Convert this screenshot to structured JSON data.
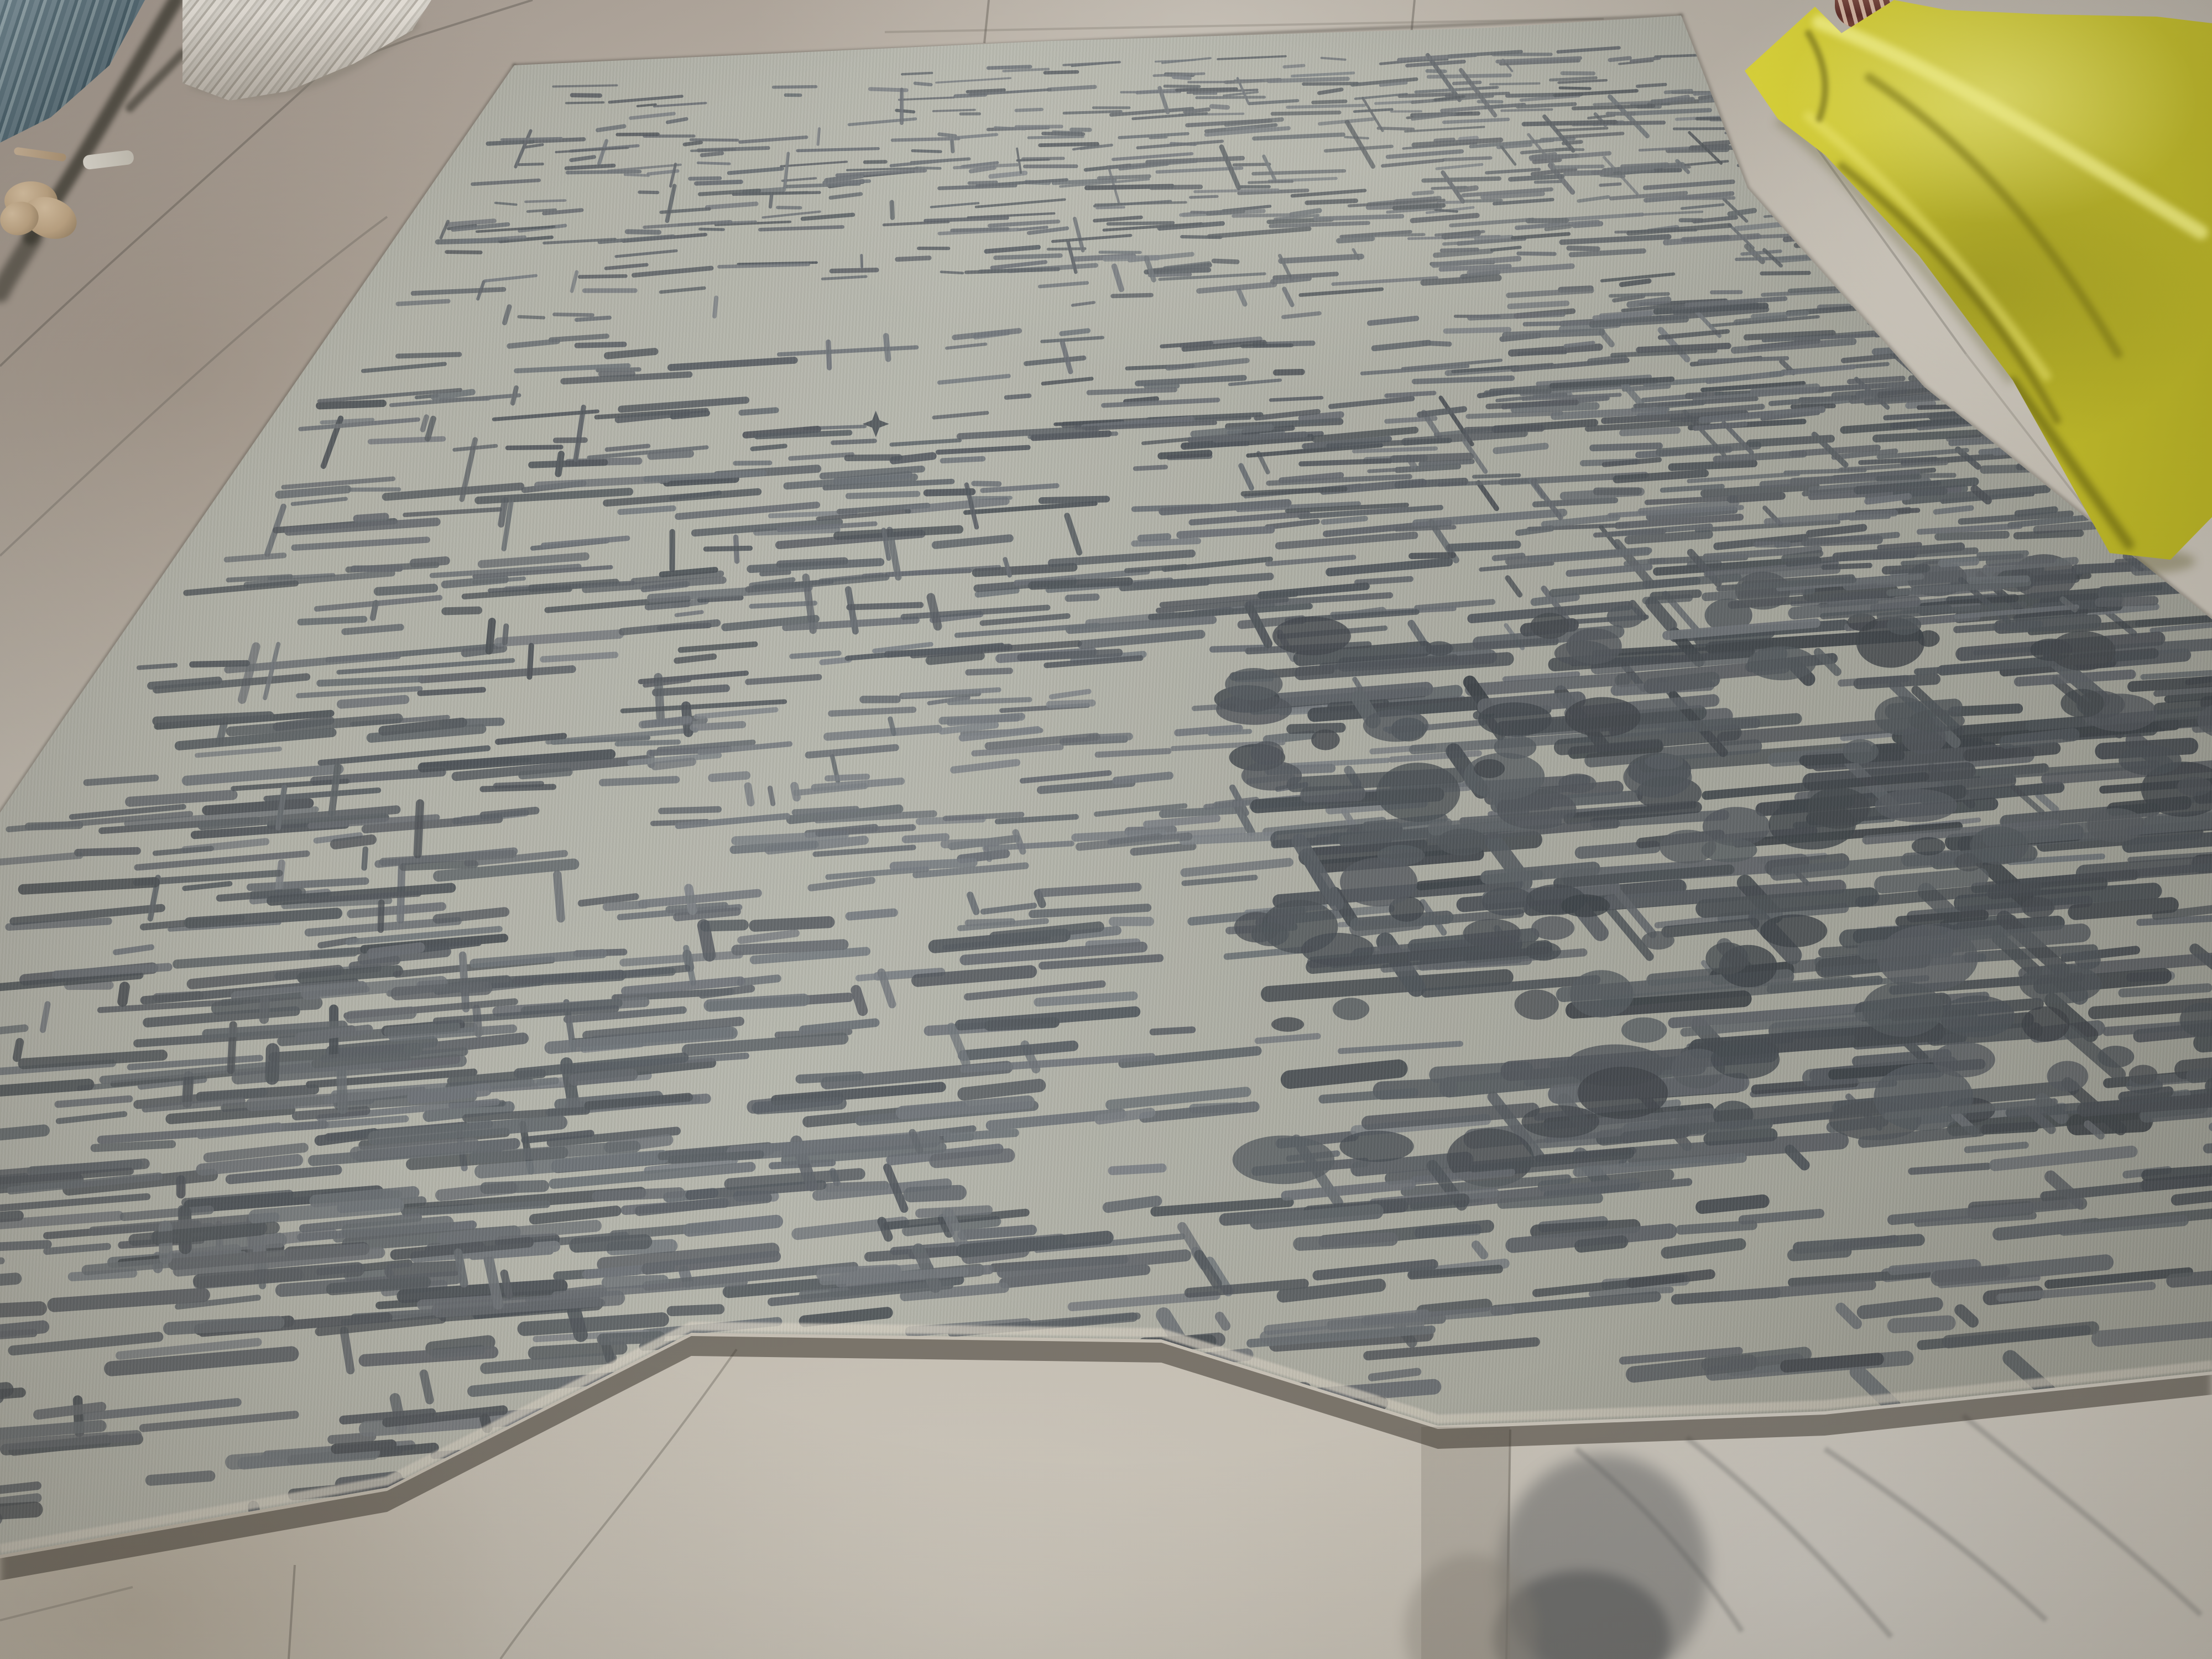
{
  "scene": {
    "type": "photograph",
    "description": "Large gray hand-tufted area rug with an abstract charcoal scratched-grid pattern, laid on a white marble showroom floor; a crumpled bright-yellow tarp lies at the top right, a blue plastic crate and a rolled white carpet at the top left, with a small tan yarn bundle nearby.",
    "objects": [
      {
        "name": "area-rug",
        "color": "#b2b3a9",
        "pattern_color": "#3e444a"
      },
      {
        "name": "marble-floor",
        "color": "#c0bab0"
      },
      {
        "name": "yellow-tarp",
        "color": "#e4dd35"
      },
      {
        "name": "plastic-crate",
        "color": "#5d7985"
      },
      {
        "name": "rolled-carpet",
        "color": "#d8d3c9"
      },
      {
        "name": "yarn-bundle",
        "color": "#c3a987"
      },
      {
        "name": "rope-strand",
        "color": "#c0a788"
      },
      {
        "name": "fabric-scrap",
        "color": "#dcd8ce"
      },
      {
        "name": "sandal-foot",
        "color": "#6b3730"
      }
    ]
  },
  "palette": {
    "floor_pink": "#a89d93",
    "floor_light": "#c7c2b8",
    "floor_bottom": "#c3bcb0",
    "floor_white_tile": "#cbc8c2",
    "floor_dark_vein": "#5e6062",
    "rug_ground": "#b2b3a9",
    "rug_mark_light": "#7d8287",
    "rug_mark_dark": "#3e444a",
    "rug_binding": "#d5cfc2",
    "cast_shadow": "#4a463f",
    "tarp_yellow": "#e4dd35",
    "tarp_highlight": "#f6f283",
    "tarp_shadow": "#8f8a16",
    "crate_blue": "#5d7985",
    "yarn_tan": "#c3a987",
    "sandal_maroon": "#6b3730"
  },
  "rug": {
    "quad": {
      "tl": [
        930,
        118
      ],
      "tr": [
        3046,
        30
      ],
      "br": [
        5128,
        2375
      ],
      "bl": [
        -985,
        2893
      ]
    },
    "pattern": {
      "seed": 7,
      "mark_rgb_light": [
        125,
        130,
        135
      ],
      "mark_rgb_dark": [
        58,
        64,
        70
      ],
      "motif": {
        "u": 0.365,
        "v": 0.26,
        "size": 24
      },
      "zones": [
        {
          "name": "base-scatter",
          "u": [
            0.02,
            0.97
          ],
          "v": [
            0.02,
            0.97
          ],
          "n": 500,
          "len": [
            0.012,
            0.05
          ],
          "th": [
            7,
            14
          ],
          "dark": [
            0.42,
            0.72
          ],
          "vert": 0.1
        },
        {
          "name": "top-band",
          "u": [
            0.03,
            0.97
          ],
          "v": [
            0.015,
            0.16
          ],
          "n": 270,
          "len": [
            0.012,
            0.065
          ],
          "th": [
            6,
            12
          ],
          "dark": [
            0.5,
            0.8
          ],
          "vert": 0.08
        },
        {
          "name": "top-right-cluster",
          "u": [
            0.45,
            0.97
          ],
          "v": [
            0.02,
            0.3
          ],
          "n": 210,
          "len": [
            0.015,
            0.07
          ],
          "th": [
            7,
            14
          ],
          "dark": [
            0.55,
            0.85
          ],
          "vert": 0.13
        },
        {
          "name": "left-band",
          "u": [
            0.01,
            0.3
          ],
          "v": [
            0.2,
            0.8
          ],
          "n": 270,
          "len": [
            0.015,
            0.085
          ],
          "th": [
            8,
            17
          ],
          "dark": [
            0.5,
            0.85
          ],
          "vert": 0.15
        },
        {
          "name": "mid-band",
          "u": [
            0.3,
            0.95
          ],
          "v": [
            0.27,
            0.44
          ],
          "n": 200,
          "len": [
            0.02,
            0.08
          ],
          "th": [
            8,
            16
          ],
          "dark": [
            0.55,
            0.85
          ],
          "vert": 0.1
        },
        {
          "name": "center-sparse",
          "u": [
            0.28,
            0.62
          ],
          "v": [
            0.45,
            0.63
          ],
          "n": 110,
          "len": [
            0.012,
            0.05
          ],
          "th": [
            8,
            14
          ],
          "dark": [
            0.4,
            0.65
          ],
          "vert": 0.1
        },
        {
          "name": "bottom-right-mega",
          "u": [
            0.55,
            0.99
          ],
          "v": [
            0.42,
            0.82
          ],
          "n": 340,
          "len": [
            0.02,
            0.095
          ],
          "th": [
            11,
            26
          ],
          "dark": [
            0.62,
            0.95
          ],
          "vert": 0.17,
          "blobs": 120
        },
        {
          "name": "right-mid",
          "u": [
            0.7,
            0.99
          ],
          "v": [
            0.15,
            0.45
          ],
          "n": 150,
          "len": [
            0.015,
            0.07
          ],
          "th": [
            8,
            16
          ],
          "dark": [
            0.5,
            0.8
          ],
          "vert": 0.12
        },
        {
          "name": "bottom-band",
          "u": [
            0.05,
            0.95
          ],
          "v": [
            0.8,
            0.985
          ],
          "n": 260,
          "len": [
            0.012,
            0.06
          ],
          "th": [
            9,
            18
          ],
          "dark": [
            0.5,
            0.88
          ],
          "vert": 0.14
        },
        {
          "name": "low-left-cluster",
          "u": [
            0.14,
            0.45
          ],
          "v": [
            0.6,
            0.86
          ],
          "n": 160,
          "len": [
            0.015,
            0.07
          ],
          "th": [
            9,
            19
          ],
          "dark": [
            0.5,
            0.82
          ],
          "vert": 0.13
        }
      ]
    }
  }
}
